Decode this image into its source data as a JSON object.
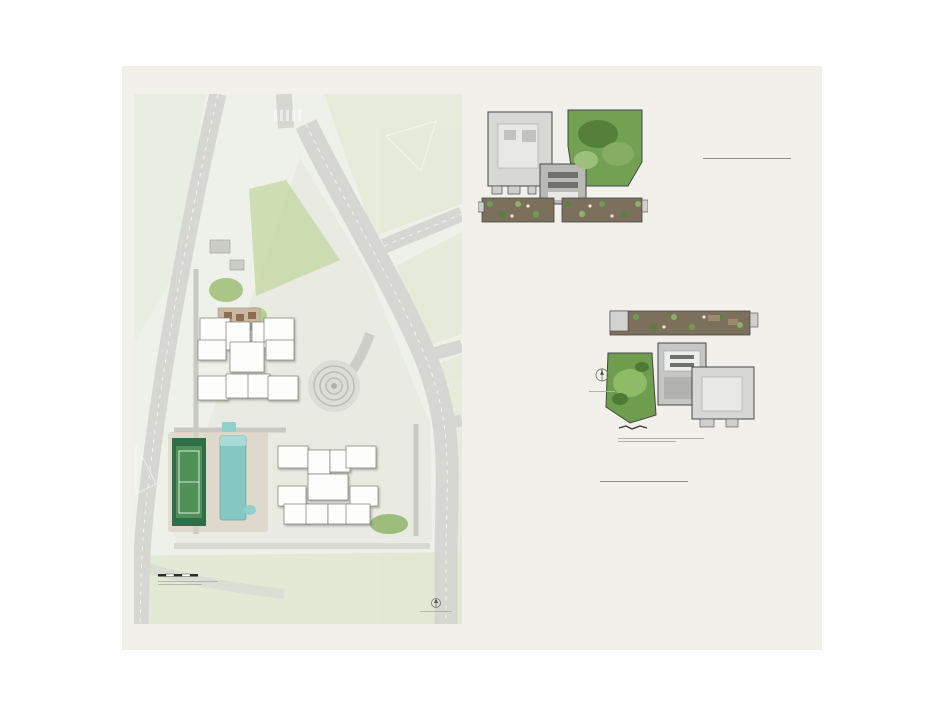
{
  "roof_terrace": {
    "title": "ROOF TERRACE",
    "items": [
      {
        "num": "26",
        "label": "Sky Cabanas"
      },
      {
        "num": "27",
        "label": "Sky Lounges"
      },
      {
        "num": "28",
        "label": "Sky Playgrounds & Gyms"
      },
      {
        "num": "29",
        "label": "Water Tanks"
      }
    ]
  },
  "facilities_deck": {
    "title": "FACILITIES DECK",
    "columns": [
      [
        {
          "num": "1",
          "label": "Guard House"
        },
        {
          "num": "2",
          "label": "Side Gate / Pedestrian Access"
        },
        {
          "num": "3",
          "label": "Arrival Plaza"
        },
        {
          "num": "4",
          "label": "Sheltered Walkway"
        },
        {
          "num": "5",
          "label": "Function Room (below deck)"
        },
        {
          "num": "6",
          "label": "Changing Rooms (below deck)"
        },
        {
          "num": "7",
          "label": "Gymnasium (below deck)"
        },
        {
          "num": "8",
          "label": "Fitness Trail and Stations"
        },
        {
          "num": "9",
          "label": "Tennis Court"
        }
      ],
      [
        {
          "num": "10",
          "label": "25m Lap Pool"
        },
        {
          "num": "11",
          "label": "Spa Pool"
        },
        {
          "num": "12",
          "label": "Pool Deck"
        },
        {
          "num": "13",
          "label": "Poolside Cabanas"
        },
        {
          "num": "14",
          "label": "Dining Pavilions\nwith BBQ Pit"
        },
        {
          "num": "15",
          "label": "Children's Splash Pool"
        },
        {
          "num": "16",
          "label": "Children's Playground"
        },
        {
          "num": "17",
          "label": "Viewing Deck"
        }
      ],
      [
        {
          "num": "18",
          "label": "Bicycle Parking (below deck)"
        },
        {
          "num": "19",
          "label": "Party Lawn"
        },
        {
          "num": "20",
          "label": "Jogging Trail"
        },
        {
          "num": "21",
          "label": "Bin Centre"
        },
        {
          "num": "22",
          "label": "Electrical Substation"
        },
        {
          "num": "23",
          "label": "Ventilation Shafts\n(at deck level)"
        },
        {
          "num": "24",
          "label": "Bulk Water Meter"
        },
        {
          "num": "25",
          "label": "Genset"
        }
      ]
    ]
  },
  "roof_plan_207": {
    "caption": "BLOCK 207",
    "markers": [
      {
        "num": "29",
        "x": 42,
        "y": 31
      },
      {
        "num": "28",
        "x": 122,
        "y": 33
      },
      {
        "num": "26",
        "x": 44,
        "y": 96
      },
      {
        "num": "26",
        "x": 99,
        "y": 90
      },
      {
        "num": "26",
        "x": 115,
        "y": 92
      },
      {
        "num": "27",
        "x": 132,
        "y": 91
      }
    ]
  },
  "roof_plan_205": {
    "caption": "BLOCK 205",
    "north_label": "N",
    "markers": [
      {
        "num": "27",
        "x": 29,
        "y": 31
      },
      {
        "num": "26",
        "x": 52,
        "y": 29
      },
      {
        "num": "26",
        "x": 67,
        "y": 30
      },
      {
        "num": "27",
        "x": 113,
        "y": 24
      },
      {
        "num": "28",
        "x": 49,
        "y": 87
      },
      {
        "num": "29",
        "x": 125,
        "y": 89
      }
    ]
  },
  "site_plan": {
    "north_label": "N",
    "block207_core_label": "BLOCK\n207",
    "block205_core_label": "BLOCK\n205",
    "unit_numbers_207": [
      {
        "n": "12",
        "x": 81,
        "y": 238
      },
      {
        "n": "13",
        "x": 104,
        "y": 244
      },
      {
        "n": "14",
        "x": 128,
        "y": 243
      },
      {
        "n": "15",
        "x": 145,
        "y": 238
      },
      {
        "n": "11",
        "x": 78,
        "y": 258
      },
      {
        "n": "16",
        "x": 146,
        "y": 258
      },
      {
        "n": "20",
        "x": 79,
        "y": 296
      },
      {
        "n": "19",
        "x": 104,
        "y": 294
      },
      {
        "n": "18",
        "x": 125,
        "y": 294
      },
      {
        "n": "17",
        "x": 149,
        "y": 296
      }
    ],
    "unit_numbers_205": [
      {
        "n": "7",
        "x": 159,
        "y": 363
      },
      {
        "n": "8",
        "x": 185,
        "y": 367
      },
      {
        "n": "9",
        "x": 206,
        "y": 366
      },
      {
        "n": "10",
        "x": 227,
        "y": 363
      },
      {
        "n": "6",
        "x": 158,
        "y": 402
      },
      {
        "n": "1",
        "x": 230,
        "y": 402
      },
      {
        "n": "5",
        "x": 163,
        "y": 420
      },
      {
        "n": "4",
        "x": 183,
        "y": 419
      },
      {
        "n": "3",
        "x": 204,
        "y": 420
      },
      {
        "n": "2",
        "x": 224,
        "y": 420
      }
    ],
    "markers": [
      {
        "n": "21",
        "x": 109,
        "y": 94
      },
      {
        "n": "22",
        "x": 88,
        "y": 129
      },
      {
        "n": "23",
        "x": 82,
        "y": 155
      },
      {
        "n": "2",
        "x": 65,
        "y": 164
      },
      {
        "n": "18",
        "x": 93,
        "y": 177
      },
      {
        "n": "19",
        "x": 93,
        "y": 196
      },
      {
        "n": "14",
        "x": 133,
        "y": 196
      },
      {
        "n": "1",
        "x": 206,
        "y": 263
      },
      {
        "n": "3",
        "x": 176,
        "y": 316
      },
      {
        "n": "4",
        "x": 192,
        "y": 330
      },
      {
        "n": "25",
        "x": 228,
        "y": 329
      },
      {
        "n": "24",
        "x": 226,
        "y": 407
      },
      {
        "n": "23",
        "x": 257,
        "y": 413
      },
      {
        "n": "17",
        "x": 210,
        "y": 438
      },
      {
        "n": "20",
        "x": 32,
        "y": 377
      },
      {
        "n": "11",
        "x": 83,
        "y": 356
      },
      {
        "n": "13",
        "x": 112,
        "y": 354
      },
      {
        "n": "4",
        "x": 142,
        "y": 361
      },
      {
        "n": "12",
        "x": 114,
        "y": 388
      },
      {
        "n": "10",
        "x": 95,
        "y": 389
      },
      {
        "n": "9",
        "x": 55,
        "y": 392
      },
      {
        "n": "15",
        "x": 117,
        "y": 414
      },
      {
        "n": "16",
        "x": 98,
        "y": 426
      },
      {
        "n": "2",
        "x": 26,
        "y": 420
      },
      {
        "n": "8",
        "x": 55,
        "y": 460
      },
      {
        "n": "8",
        "x": 91,
        "y": 456
      },
      {
        "n": "8",
        "x": 123,
        "y": 453
      },
      {
        "n": "8",
        "x": 172,
        "y": 453
      },
      {
        "n": "8",
        "x": 248,
        "y": 453
      }
    ]
  },
  "colors": {
    "gold": "#c59c62",
    "card_bg": "#f1f0ea",
    "title": "#3d3d3d"
  }
}
